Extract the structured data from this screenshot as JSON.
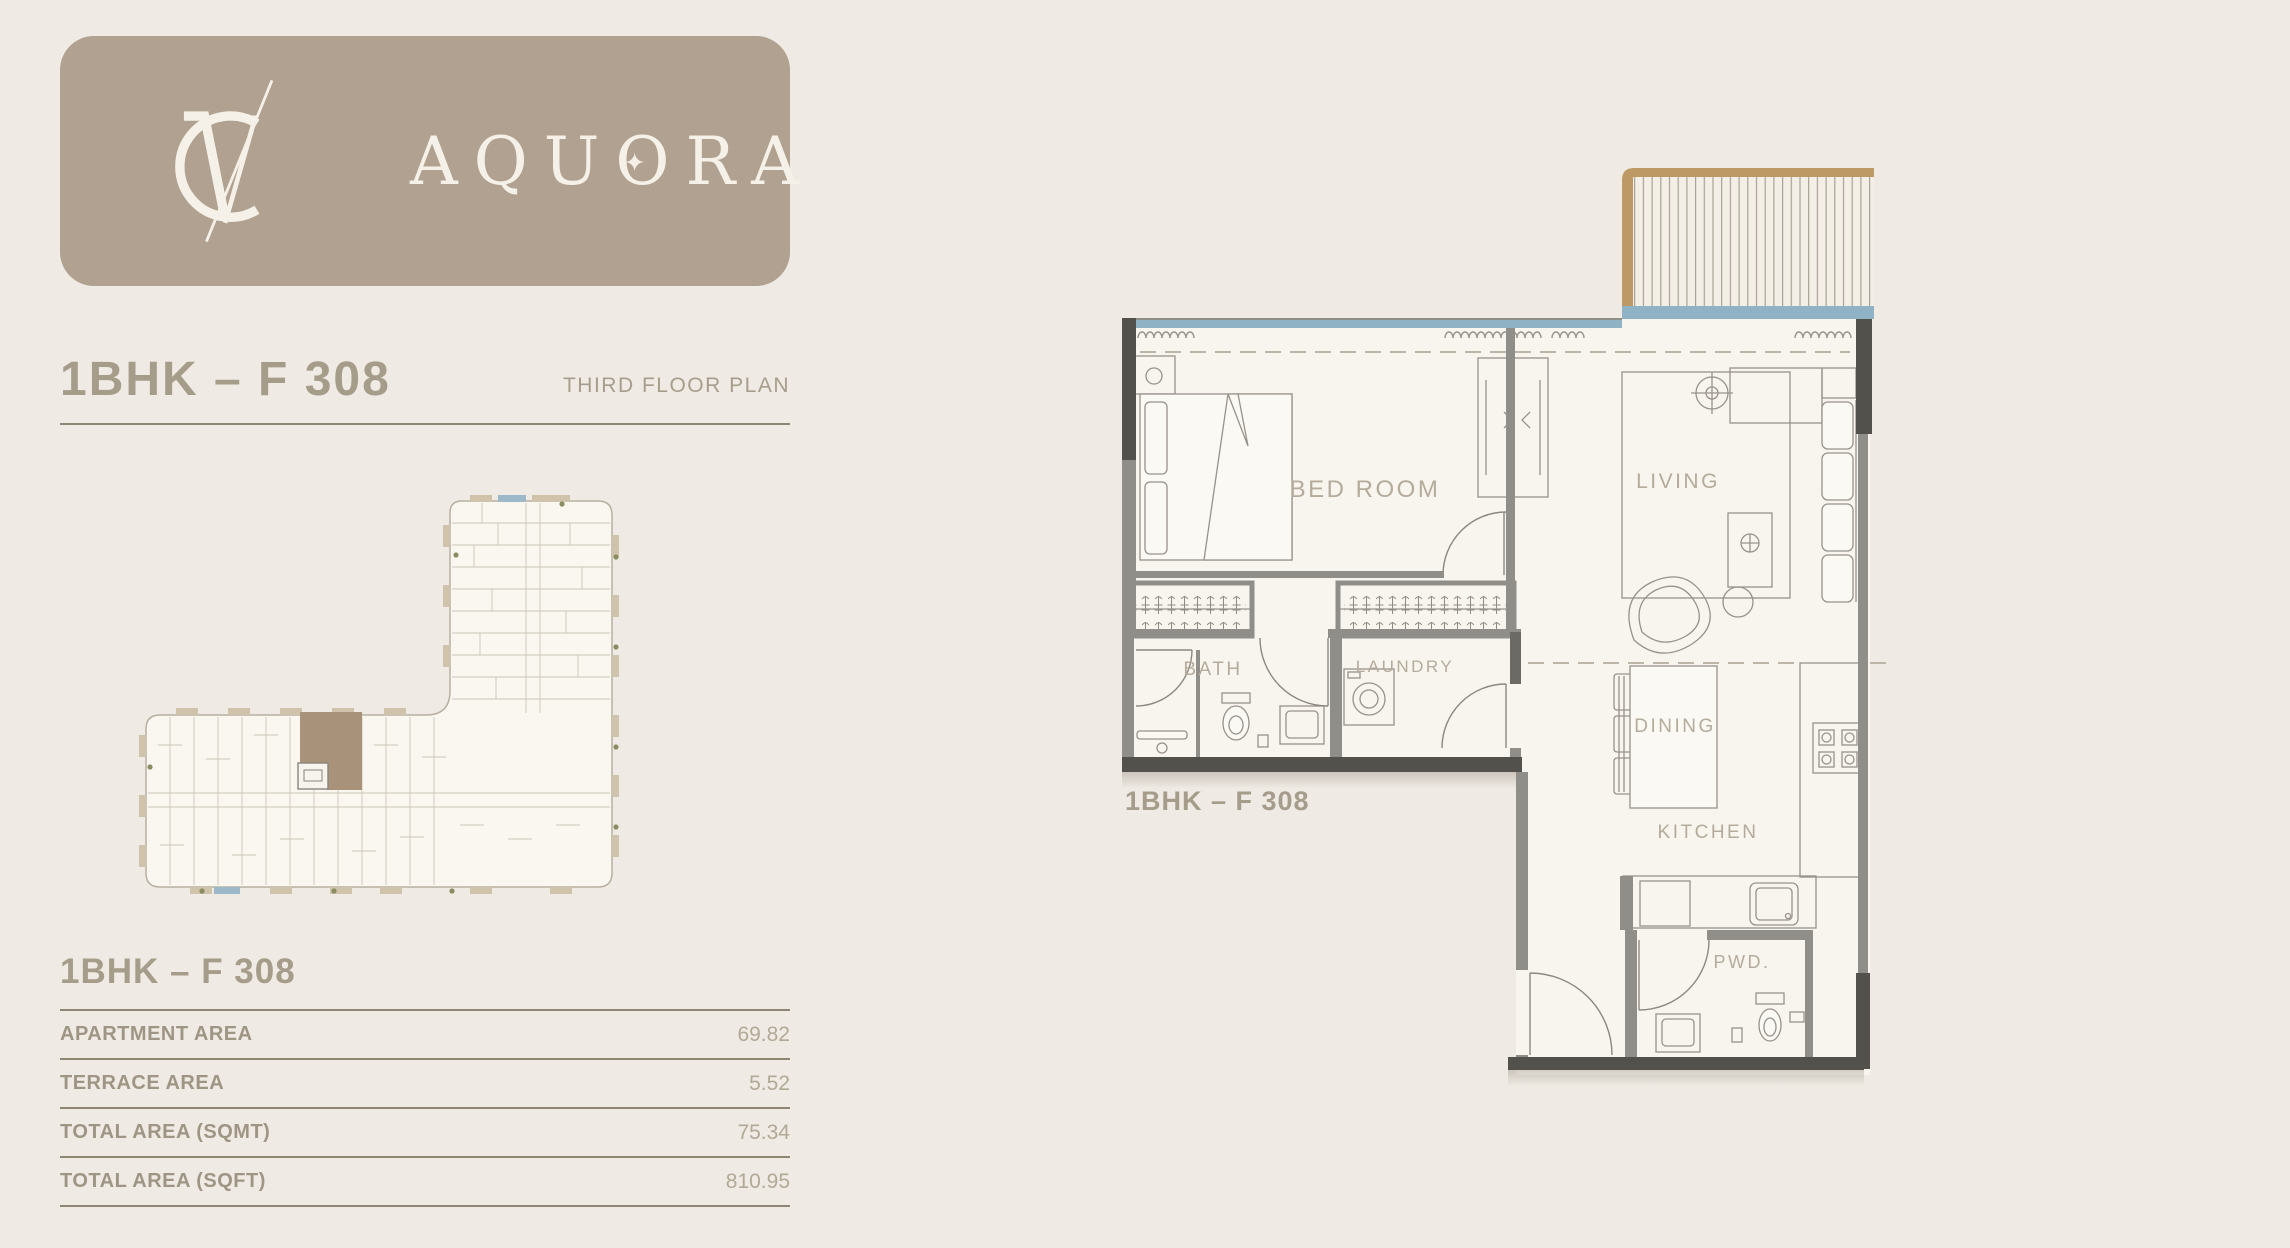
{
  "brand": {
    "monogram": "VC",
    "name": "AQUORA",
    "card_color": "#b0a190",
    "text_color": "#f6f1e8"
  },
  "header": {
    "title": "1BHK – F 308",
    "subtitle": "THIRD FLOOR PLAN",
    "text_color": "#a69c8a",
    "rule_color": "#8e8575"
  },
  "key_plan": {
    "highlight_color": "#a8937a",
    "balcony_color": "#cfc3ab",
    "window_color": "#9db8c8"
  },
  "area_table": {
    "title": "1BHK – F 308",
    "rows": [
      {
        "label": "APARTMENT AREA",
        "value": "69.82"
      },
      {
        "label": "TERRACE AREA",
        "value": "5.52"
      },
      {
        "label": "TOTAL AREA (SQMT)",
        "value": "75.34"
      },
      {
        "label": "TOTAL AREA (SQFT)",
        "value": "810.95"
      }
    ]
  },
  "floor_plan": {
    "unit_label": "1BHK – F 308",
    "rooms": {
      "bedroom": "BED ROOM",
      "living": "LIVING",
      "bath": "BATH",
      "laundry": "LAUNDRY",
      "dining": "DINING",
      "kitchen": "KITCHEN",
      "powder": "PWD."
    },
    "colors": {
      "wall": "#908e88",
      "wall_dark": "#52514c",
      "interior": "#f8f5ef",
      "glass": "#8fb2c5",
      "terrace_wood": "#bd9965",
      "label": "#b4ab9b"
    }
  }
}
